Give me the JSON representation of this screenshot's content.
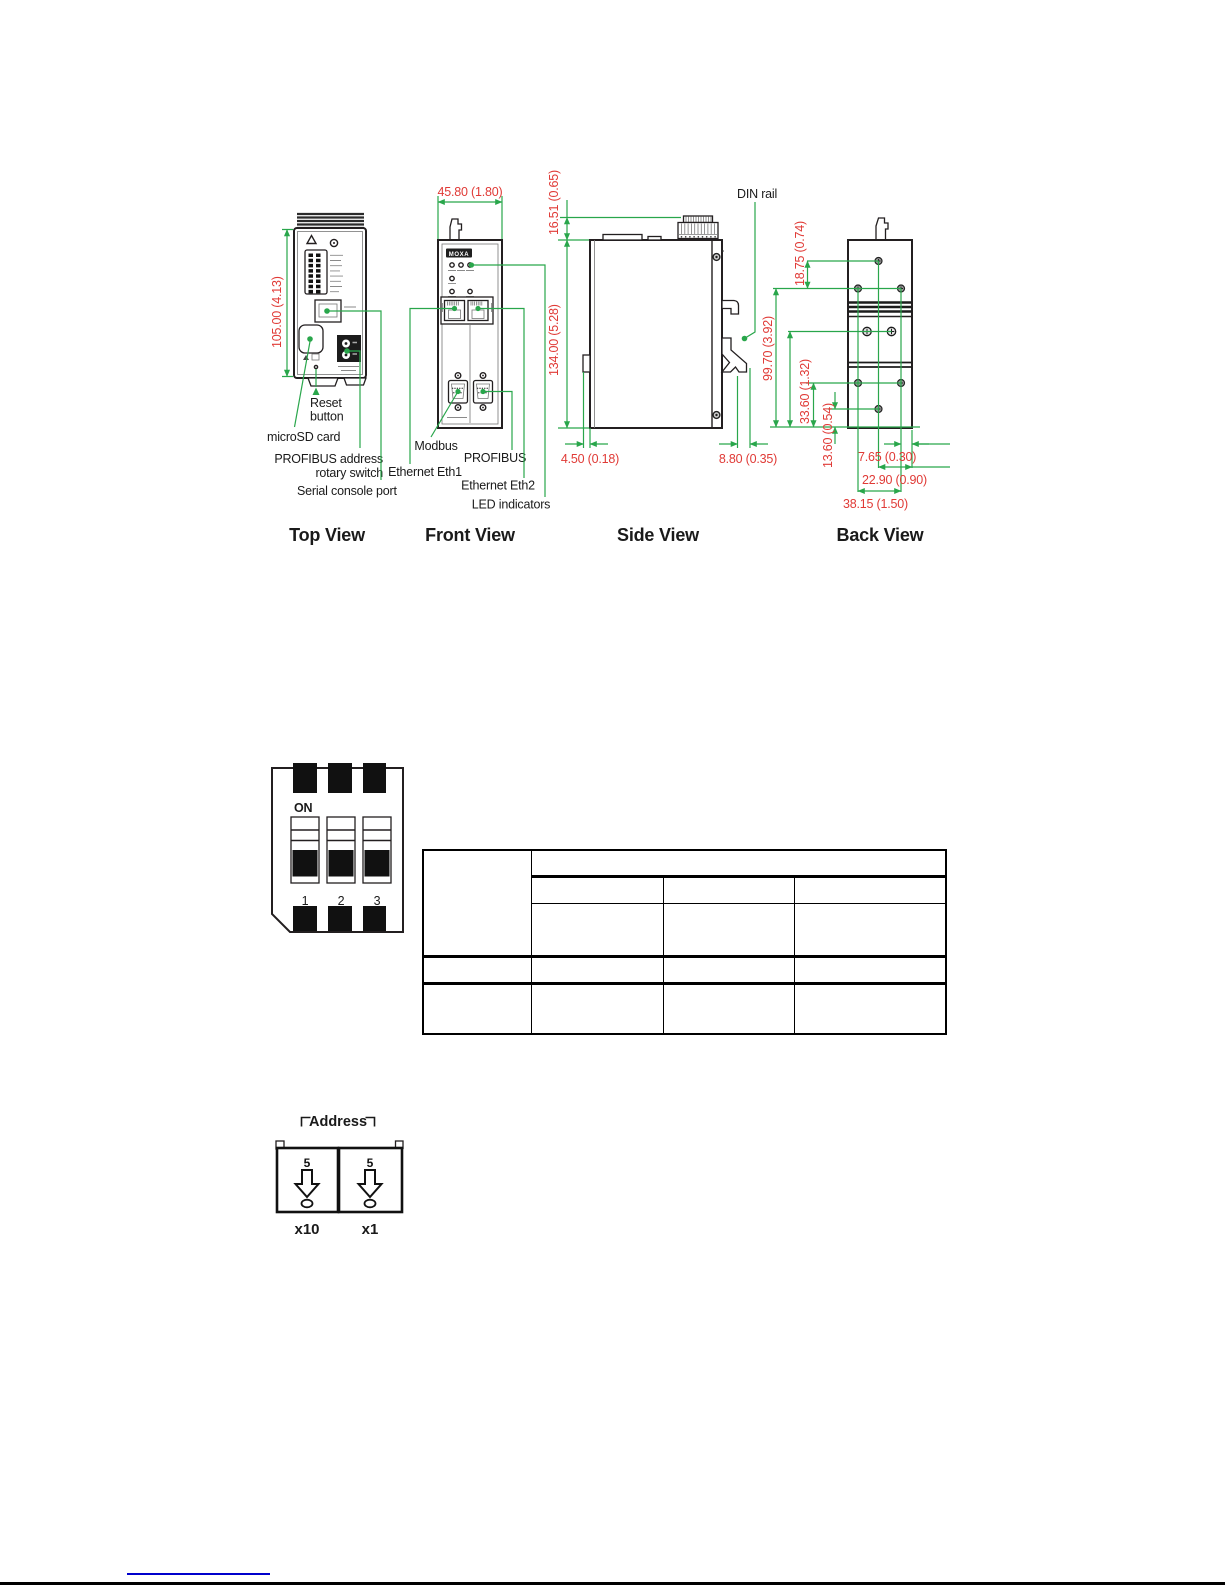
{
  "colors": {
    "dimension_red": "#e03a36",
    "callout_green": "#29a64b",
    "drawing_black": "#231f20",
    "link_blue": "#0000cc"
  },
  "figure": {
    "top_view": {
      "caption": "Top View",
      "dim_height": "105.00 (4.13)",
      "callout_reset_line1": "Reset",
      "callout_reset_line2": "button",
      "callout_microsd": "microSD card",
      "callout_profibus_line1": "PROFIBUS address",
      "callout_profibus_line2": "rotary switch",
      "callout_serial": "Serial console port"
    },
    "front_view": {
      "caption": "Front  View",
      "dim_width": "45.80 (1.80)",
      "logo": "MOXA",
      "callout_modbus": "Modbus",
      "callout_profibus": "PROFIBUS",
      "callout_eth1": "Ethernet Eth1",
      "callout_eth2": "Ethernet Eth2",
      "callout_led": "LED indicators"
    },
    "side_view": {
      "caption": "Side View",
      "label_din_rail": "DIN rail",
      "dim_terminal": "16.51 (0.65)",
      "dim_body_height": "134.00 (5.28)",
      "dim_bottom_left": "4.50 (0.18)",
      "dim_bottom_right": "8.80 (0.35)"
    },
    "back_view": {
      "caption": "Back View",
      "dim_top_screw": "18.75 (0.74)",
      "dim_screw_span": "99.70 (3.92)",
      "dim_lower_screw": "33.60 (1.32)",
      "dim_bottom_screw": "13.60 (0.54)",
      "dim_width_small": "7.65 (0.30)",
      "dim_width_mid": "22.90 (0.90)",
      "dim_width_large": "38.15 (1.50)"
    }
  },
  "dip_switch": {
    "on_label": "ON",
    "positions": [
      "1",
      "2",
      "3"
    ]
  },
  "config_table": {
    "rows": [
      [
        "",
        ""
      ],
      [
        "",
        "",
        ""
      ],
      [
        "",
        "",
        ""
      ],
      [
        "",
        "",
        "",
        ""
      ],
      [
        "",
        "",
        "",
        ""
      ]
    ]
  },
  "rotary_switch": {
    "title": "Address",
    "dial_value": "5",
    "multiplier_left": "x10",
    "multiplier_right": "x1"
  }
}
